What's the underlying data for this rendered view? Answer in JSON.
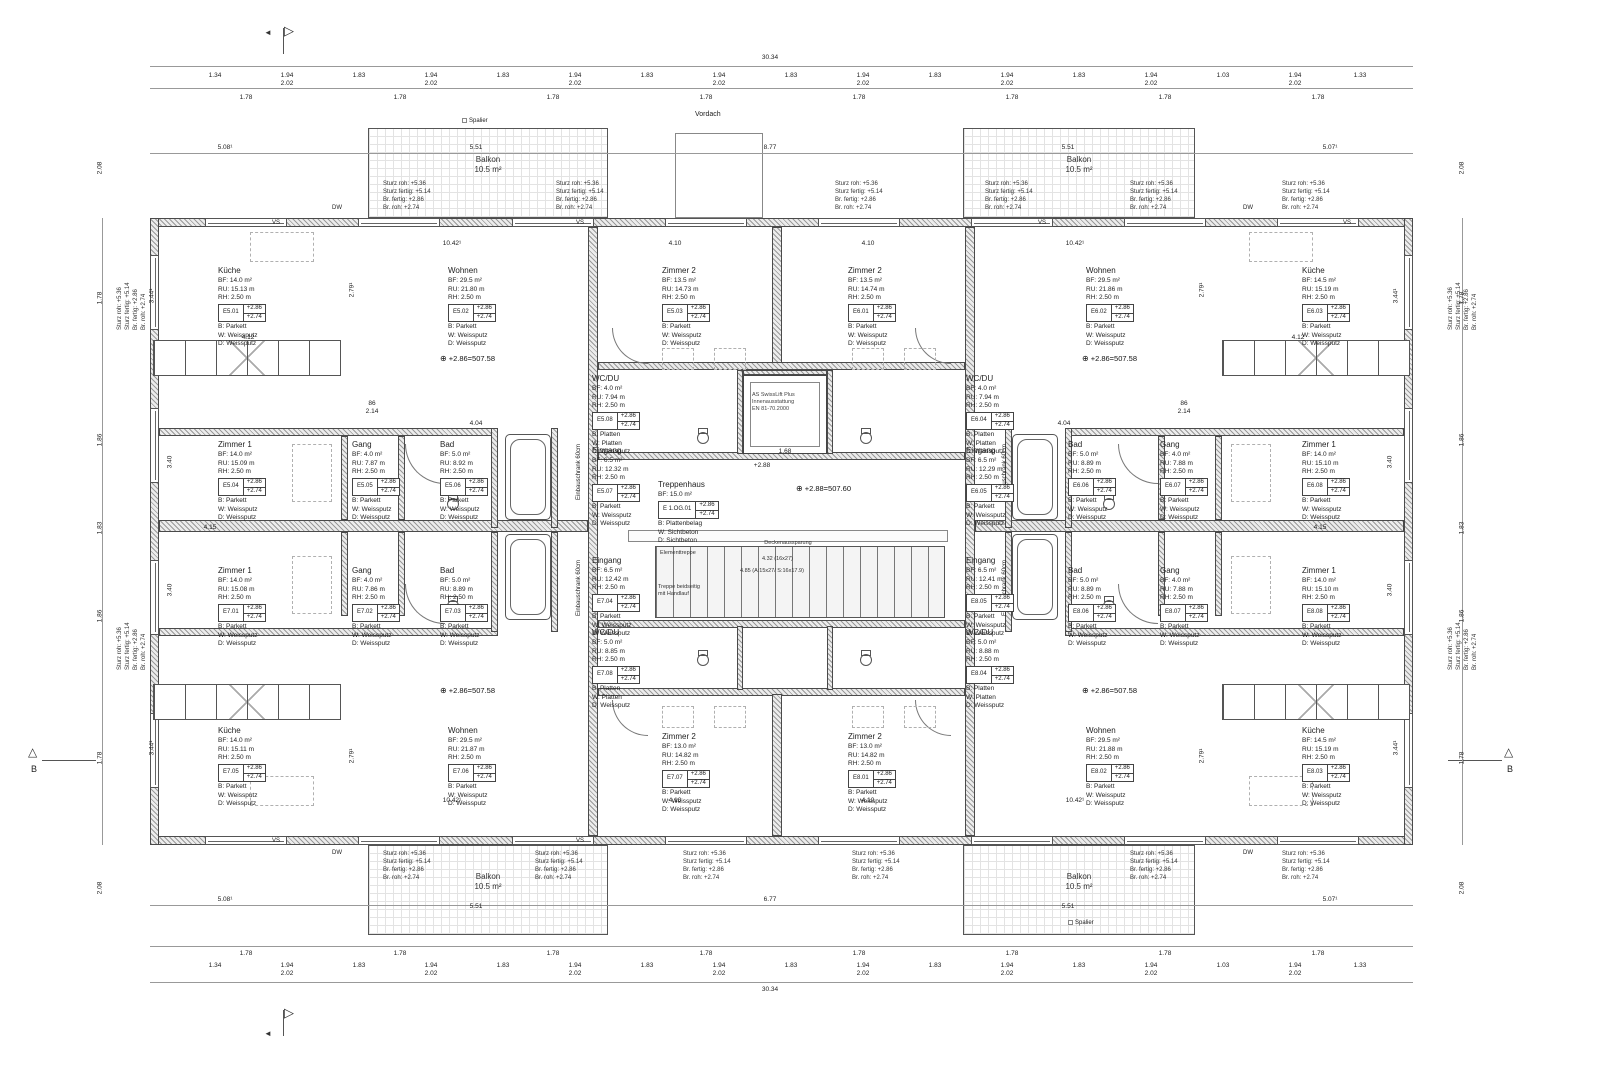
{
  "markers": {
    "section_b": "B"
  },
  "labels": {
    "balkon_title": "Balkon",
    "balkon_area": "10.5 m²",
    "vordach": "Vordach",
    "spalier": "Spalier",
    "level_wing": "+2.86=507.58",
    "level_core": "+2.88=507.60",
    "sturz": [
      "Sturz roh:   +5.36",
      "Sturz fertig: +5.14",
      "Br. fertig:   +2.86",
      "Br. roh:      +2.74"
    ],
    "lift": [
      "AS SwissLift Plus",
      "Innenausstattung",
      "EN 81-70.2000"
    ],
    "elementtreppe": "Elementtreppe",
    "deckenaussparung": "Deckenaussparung",
    "stair_dim1": "4.32 (16x27)",
    "stair_dim2": "4.85 (A:15x27/ S:16x17.9)",
    "stair_note": "Treppe beidseitig mit Handlauf",
    "einbauschrank": "Einbauschrank 60cm",
    "vs": "VS",
    "dw": "DW"
  },
  "dims": {
    "d3034": "30.34",
    "d194": "1.94",
    "d202": "2.02",
    "d183": "1.83",
    "d178": "1.78",
    "d134": "1.34",
    "d103": "1.03",
    "d133": "1.33",
    "d208": "2.08",
    "d186": "1.86",
    "d1042": "10.42¹",
    "d410": "4.10",
    "d877": "8.77",
    "d677": "6.77",
    "d508": "5.08¹",
    "d507": "5.07¹",
    "d551": "5.51",
    "d412": "4.12",
    "d415": "4.15",
    "d404": "4.04",
    "d214": "2.14",
    "d86": "86",
    "d344": "3.44¹",
    "d279": "2.79¹",
    "d340": "3.40",
    "d288": "+2.88",
    "d168": "1.68"
  },
  "rooms": {
    "e5_01": {
      "title": "Küche",
      "bf": "BF: 14.0 m²",
      "ru": "RU: 15.13 m",
      "rh": "RH: 2.50 m",
      "nr": "E5.01",
      "l1": "+2.86",
      "l2": "+2.74",
      "m1": "B: Parkett",
      "m2": "W: Weissputz",
      "m3": "D: Weissputz"
    },
    "e5_02": {
      "title": "Wohnen",
      "bf": "BF: 29.5 m²",
      "ru": "RU: 21.80 m",
      "rh": "RH: 2.50 m",
      "nr": "E5.02",
      "l1": "+2.86",
      "l2": "+2.74",
      "m1": "B: Parkett",
      "m2": "W: Weissputz",
      "m3": "D: Weissputz"
    },
    "e5_03": {
      "title": "Zimmer 2",
      "bf": "BF: 13.5 m²",
      "ru": "RU: 14.73 m",
      "rh": "RH: 2.50 m",
      "nr": "E5.03",
      "l1": "+2.86",
      "l2": "+2.74",
      "m1": "B: Parkett",
      "m2": "W: Weissputz",
      "m3": "D: Weissputz"
    },
    "e5_04": {
      "title": "Zimmer 1",
      "bf": "BF: 14.0 m²",
      "ru": "RU: 15.09 m",
      "rh": "RH: 2.50 m",
      "nr": "E5.04",
      "l1": "+2.86",
      "l2": "+2.74",
      "m1": "B: Parkett",
      "m2": "W: Weissputz",
      "m3": "D: Weissputz"
    },
    "e5_05": {
      "title": "Gang",
      "bf": "BF: 4.0 m²",
      "ru": "RU: 7.87 m",
      "rh": "RH: 2.50 m",
      "nr": "E5.05",
      "l1": "+2.86",
      "l2": "+2.74",
      "m1": "B: Parkett",
      "m2": "W: Weissputz",
      "m3": "D: Weissputz"
    },
    "e5_06": {
      "title": "Bad",
      "bf": "BF: 5.0 m²",
      "ru": "RU: 8.92 m",
      "rh": "RH: 2.50 m",
      "nr": "E5.06",
      "l1": "+2.86",
      "l2": "+2.74",
      "m1": "B: Parkett",
      "m2": "W: Weissputz",
      "m3": "D: Weissputz"
    },
    "e5_07": {
      "title": "Eingang",
      "bf": "BF: 6.5 m²",
      "ru": "RU: 12.32 m",
      "rh": "RH: 2.50 m",
      "nr": "E5.07",
      "l1": "+2.86",
      "l2": "+2.74",
      "m1": "B: Parkett",
      "m2": "W: Weissputz",
      "m3": "D: Weissputz"
    },
    "e5_08": {
      "title": "WC/DU",
      "bf": "BF: 4.0 m²",
      "ru": "RU: 7.94 m",
      "rh": "RH: 2.50 m",
      "nr": "E5.08",
      "l1": "+2.86",
      "l2": "+2.74",
      "m1": "B: Platten",
      "m2": "W: Platten",
      "m3": "D: Weissputz"
    },
    "e6_01": {
      "title": "Zimmer 2",
      "bf": "BF: 13.5 m²",
      "ru": "RU: 14.74 m",
      "rh": "RH: 2.50 m",
      "nr": "E6.01",
      "l1": "+2.86",
      "l2": "+2.74",
      "m1": "B: Parkett",
      "m2": "W: Weissputz",
      "m3": "D: Weissputz"
    },
    "e6_02": {
      "title": "Wohnen",
      "bf": "BF: 29.5 m²",
      "ru": "RU: 21.86 m",
      "rh": "RH: 2.50 m",
      "nr": "E6.02",
      "l1": "+2.86",
      "l2": "+2.74",
      "m1": "B: Parkett",
      "m2": "W: Weissputz",
      "m3": "D: Weissputz"
    },
    "e6_03": {
      "title": "Küche",
      "bf": "BF: 14.5 m²",
      "ru": "RU: 15.19 m",
      "rh": "RH: 2.50 m",
      "nr": "E6.03",
      "l1": "+2.86",
      "l2": "+2.74",
      "m1": "B: Parkett",
      "m2": "W: Weissputz",
      "m3": "D: Weissputz"
    },
    "e6_04": {
      "title": "WC/DU",
      "bf": "BF: 4.0 m²",
      "ru": "RU: 7.94 m",
      "rh": "RH: 2.50 m",
      "nr": "E6.04",
      "l1": "+2.86",
      "l2": "+2.74",
      "m1": "B: Platten",
      "m2": "W: Platten",
      "m3": "D: Weissputz"
    },
    "e6_05": {
      "title": "Eingang",
      "bf": "BF: 6.5 m²",
      "ru": "RU: 12.29 m",
      "rh": "RH: 2.50 m",
      "nr": "E6.05",
      "l1": "+2.86",
      "l2": "+2.74",
      "m1": "B: Parkett",
      "m2": "W: Weissputz",
      "m3": "D: Weissputz"
    },
    "e6_06": {
      "title": "Bad",
      "bf": "BF: 5.0 m²",
      "ru": "RU: 8.89 m",
      "rh": "RH: 2.50 m",
      "nr": "E6.06",
      "l1": "+2.86",
      "l2": "+2.74",
      "m1": "B: Parkett",
      "m2": "W: Weissputz",
      "m3": "D: Weissputz"
    },
    "e6_07": {
      "title": "Gang",
      "bf": "BF: 4.0 m²",
      "ru": "RU: 7.88 m",
      "rh": "RH: 2.50 m",
      "nr": "E6.07",
      "l1": "+2.86",
      "l2": "+2.74",
      "m1": "B: Parkett",
      "m2": "W: Weissputz",
      "m3": "D: Weissputz"
    },
    "e6_08": {
      "title": "Zimmer 1",
      "bf": "BF: 14.0 m²",
      "ru": "RU: 15.10 m",
      "rh": "RH: 2.50 m",
      "nr": "E6.08",
      "l1": "+2.86",
      "l2": "+2.74",
      "m1": "B: Parkett",
      "m2": "W: Weissputz",
      "m3": "D: Weissputz"
    },
    "e7_01": {
      "title": "Zimmer 1",
      "bf": "BF: 14.0 m²",
      "ru": "RU: 15.08 m",
      "rh": "RH: 2.50 m",
      "nr": "E7.01",
      "l1": "+2.86",
      "l2": "+2.74",
      "m1": "B: Parkett",
      "m2": "W: Weissputz",
      "m3": "D: Weissputz"
    },
    "e7_02": {
      "title": "Gang",
      "bf": "BF: 4.0 m²",
      "ru": "RU: 7.86 m",
      "rh": "RH: 2.50 m",
      "nr": "E7.02",
      "l1": "+2.86",
      "l2": "+2.74",
      "m1": "B: Parkett",
      "m2": "W: Weissputz",
      "m3": "D: Weissputz"
    },
    "e7_03": {
      "title": "Bad",
      "bf": "BF: 5.0 m²",
      "ru": "RU: 8.89 m",
      "rh": "RH: 2.50 m",
      "nr": "E7.03",
      "l1": "+2.86",
      "l2": "+2.74",
      "m1": "B: Parkett",
      "m2": "W: Weissputz",
      "m3": "D: Weissputz"
    },
    "e7_04": {
      "title": "Eingang",
      "bf": "BF: 6.5 m²",
      "ru": "RU: 12.42 m",
      "rh": "RH: 2.50 m",
      "nr": "E7.04",
      "l1": "+2.86",
      "l2": "+2.74",
      "m1": "B: Parkett",
      "m2": "W: Weissputz",
      "m3": "D: Weissputz"
    },
    "e7_05": {
      "title": "Küche",
      "bf": "BF: 14.0 m²",
      "ru": "RU: 15.11 m",
      "rh": "RH: 2.50 m",
      "nr": "E7.05",
      "l1": "+2.86",
      "l2": "+2.74",
      "m1": "B: Parkett",
      "m2": "W: Weissputz",
      "m3": "D: Weissputz"
    },
    "e7_06": {
      "title": "Wohnen",
      "bf": "BF: 29.5 m²",
      "ru": "RU: 21.87 m",
      "rh": "RH: 2.50 m",
      "nr": "E7.06",
      "l1": "+2.86",
      "l2": "+2.74",
      "m1": "B: Parkett",
      "m2": "W: Weissputz",
      "m3": "D: Weissputz"
    },
    "e7_07": {
      "title": "Zimmer 2",
      "bf": "BF: 13.0 m²",
      "ru": "RU: 14.82 m",
      "rh": "RH: 2.50 m",
      "nr": "E7.07",
      "l1": "+2.86",
      "l2": "+2.74",
      "m1": "B: Parkett",
      "m2": "W: Weissputz",
      "m3": "D: Weissputz"
    },
    "e7_08": {
      "title": "WC/DU",
      "bf": "BF: 5.0 m²",
      "ru": "RU: 8.85 m",
      "rh": "RH: 2.50 m",
      "nr": "E7.08",
      "l1": "+2.86",
      "l2": "+2.74",
      "m1": "B: Platten",
      "m2": "W: Platten",
      "m3": "D: Weissputz"
    },
    "e8_01": {
      "title": "Zimmer 2",
      "bf": "BF: 13.0 m²",
      "ru": "RU: 14.82 m",
      "rh": "RH: 2.50 m",
      "nr": "E8.01",
      "l1": "+2.86",
      "l2": "+2.74",
      "m1": "B: Parkett",
      "m2": "W: Weissputz",
      "m3": "D: Weissputz"
    },
    "e8_02": {
      "title": "Wohnen",
      "bf": "BF: 29.5 m²",
      "ru": "RU: 21.88 m",
      "rh": "RH: 2.50 m",
      "nr": "E8.02",
      "l1": "+2.86",
      "l2": "+2.74",
      "m1": "B: Parkett",
      "m2": "W: Weissputz",
      "m3": "D: Weissputz"
    },
    "e8_03": {
      "title": "Küche",
      "bf": "BF: 14.5 m²",
      "ru": "RU: 15.19 m",
      "rh": "RH: 2.50 m",
      "nr": "E8.03",
      "l1": "+2.86",
      "l2": "+2.74",
      "m1": "B: Parkett",
      "m2": "W: Weissputz",
      "m3": "D: Weissputz"
    },
    "e8_04": {
      "title": "WC/DU",
      "bf": "BF: 5.0 m²",
      "ru": "RU: 8.88 m",
      "rh": "RH: 2.50 m",
      "nr": "E8.04",
      "l1": "+2.86",
      "l2": "+2.74",
      "m1": "B: Platten",
      "m2": "W: Platten",
      "m3": "D: Weissputz"
    },
    "e8_05": {
      "title": "Eingang",
      "bf": "BF: 6.5 m²",
      "ru": "RU: 12.41 m",
      "rh": "RH: 2.50 m",
      "nr": "E8.05",
      "l1": "+2.86",
      "l2": "+2.74",
      "m1": "B: Parkett",
      "m2": "W: Weissputz",
      "m3": "D: Weissputz"
    },
    "e8_06": {
      "title": "Bad",
      "bf": "BF: 5.0 m²",
      "ru": "RU: 8.89 m",
      "rh": "RH: 2.50 m",
      "nr": "E8.06",
      "l1": "+2.86",
      "l2": "+2.74",
      "m1": "B: Parkett",
      "m2": "W: Weissputz",
      "m3": "D: Weissputz"
    },
    "e8_07": {
      "title": "Gang",
      "bf": "BF: 4.0 m²",
      "ru": "RU: 7.88 m",
      "rh": "RH: 2.50 m",
      "nr": "E8.07",
      "l1": "+2.86",
      "l2": "+2.74",
      "m1": "B: Parkett",
      "m2": "W: Weissputz",
      "m3": "D: Weissputz"
    },
    "e8_08": {
      "title": "Zimmer 1",
      "bf": "BF: 14.0 m²",
      "ru": "RU: 15.10 m",
      "rh": "RH: 2.50 m",
      "nr": "E8.08",
      "l1": "+2.86",
      "l2": "+2.74",
      "m1": "B: Parkett",
      "m2": "W: Weissputz",
      "m3": "D: Weissputz"
    },
    "trh": {
      "title": "Treppenhaus",
      "bf": "BF: 15.0 m²",
      "nr": "E 1.OG.01",
      "l1": "+2.86",
      "l2": "+2.74",
      "m1": "B: Plattenbelag",
      "m2": "W: Sichtbeton",
      "m3": "D: Sichtbeton"
    }
  }
}
